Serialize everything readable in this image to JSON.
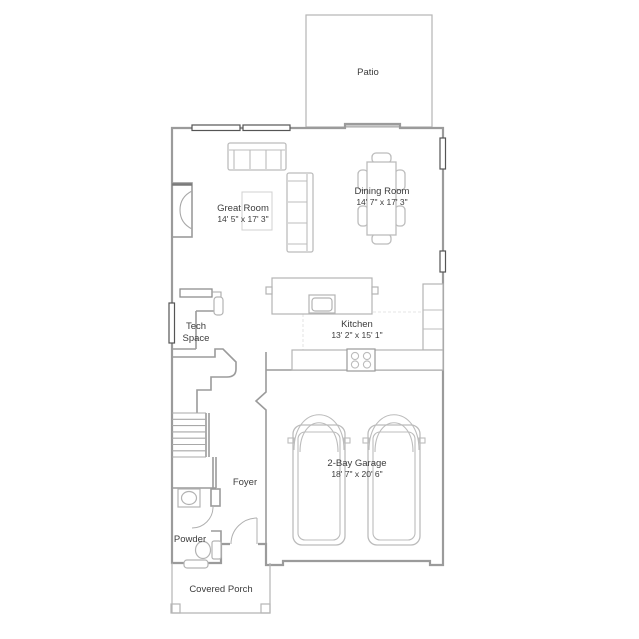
{
  "plan": {
    "type": "residential-floor-plan",
    "floor": "first-floor",
    "rooms": [
      {
        "name": "Patio",
        "dims": ""
      },
      {
        "name": "Great Room",
        "dims": "14' 5\" x 17' 3\""
      },
      {
        "name": "Dining Room",
        "dims": "14' 7\" x 17' 3\""
      },
      {
        "name": "Tech",
        "name_line2": "Space",
        "dims": ""
      },
      {
        "name": "Kitchen",
        "dims": "13' 2\" x 15' 1\""
      },
      {
        "name": "Foyer",
        "dims": ""
      },
      {
        "name": "Powder",
        "dims": ""
      },
      {
        "name": "2-Bay Garage",
        "dims": "18' 7\" x 20' 6\""
      },
      {
        "name": "Covered Porch",
        "dims": ""
      }
    ],
    "features": [
      "fireplace",
      "stairs",
      "kitchen-island",
      "cooktop",
      "sink",
      "toilet",
      "desk",
      "sofa",
      "sectional",
      "dining-table",
      "two-cars",
      "porch-posts",
      "windows",
      "patio-slider",
      "front-door"
    ],
    "colors": {
      "background": "#ffffff",
      "exterior_wall": "#9b9b9b",
      "window_frame": "#555555",
      "furniture": "#bcbcbc",
      "label_text": "#3c3c3c"
    }
  }
}
